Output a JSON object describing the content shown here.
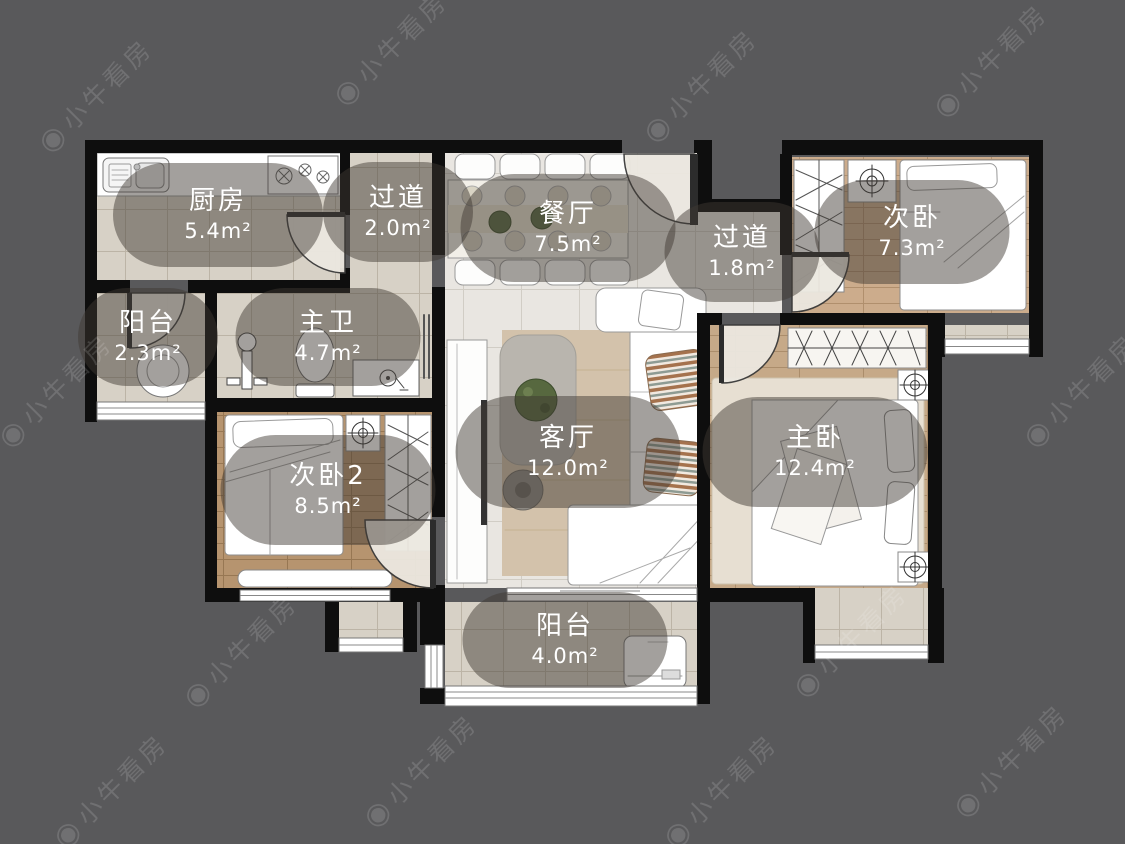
{
  "watermark": {
    "text": "小牛看房",
    "logo_glyph": "◉"
  },
  "floorplan": {
    "rooms": [
      {
        "id": "kitchen",
        "name": "厨房",
        "area": "5.4m²"
      },
      {
        "id": "hallway-1",
        "name": "过道",
        "area": "2.0m²"
      },
      {
        "id": "dining-room",
        "name": "餐厅",
        "area": "7.5m²"
      },
      {
        "id": "hallway-2",
        "name": "过道",
        "area": "1.8m²"
      },
      {
        "id": "bedroom-2",
        "name": "次卧",
        "area": "7.3m²"
      },
      {
        "id": "balcony-1",
        "name": "阳台",
        "area": "2.3m²"
      },
      {
        "id": "master-bathroom",
        "name": "主卫",
        "area": "4.7m²"
      },
      {
        "id": "bedroom-3",
        "name": "次卧2",
        "area": "8.5m²"
      },
      {
        "id": "living-room",
        "name": "客厅",
        "area": "12.0m²"
      },
      {
        "id": "master-bedroom",
        "name": "主卧",
        "area": "12.4m²"
      },
      {
        "id": "balcony-2",
        "name": "阳台",
        "area": "4.0m²"
      }
    ],
    "colors": {
      "background": "#59595b",
      "wall": "#0e0e0e",
      "tile_floor": "#d7d1c6",
      "marble_floor": "#e9e6e1",
      "wood_floor": "#c6a988",
      "label_bubble": "rgba(62,57,50,0.48)",
      "label_text": "#ffffff"
    }
  }
}
